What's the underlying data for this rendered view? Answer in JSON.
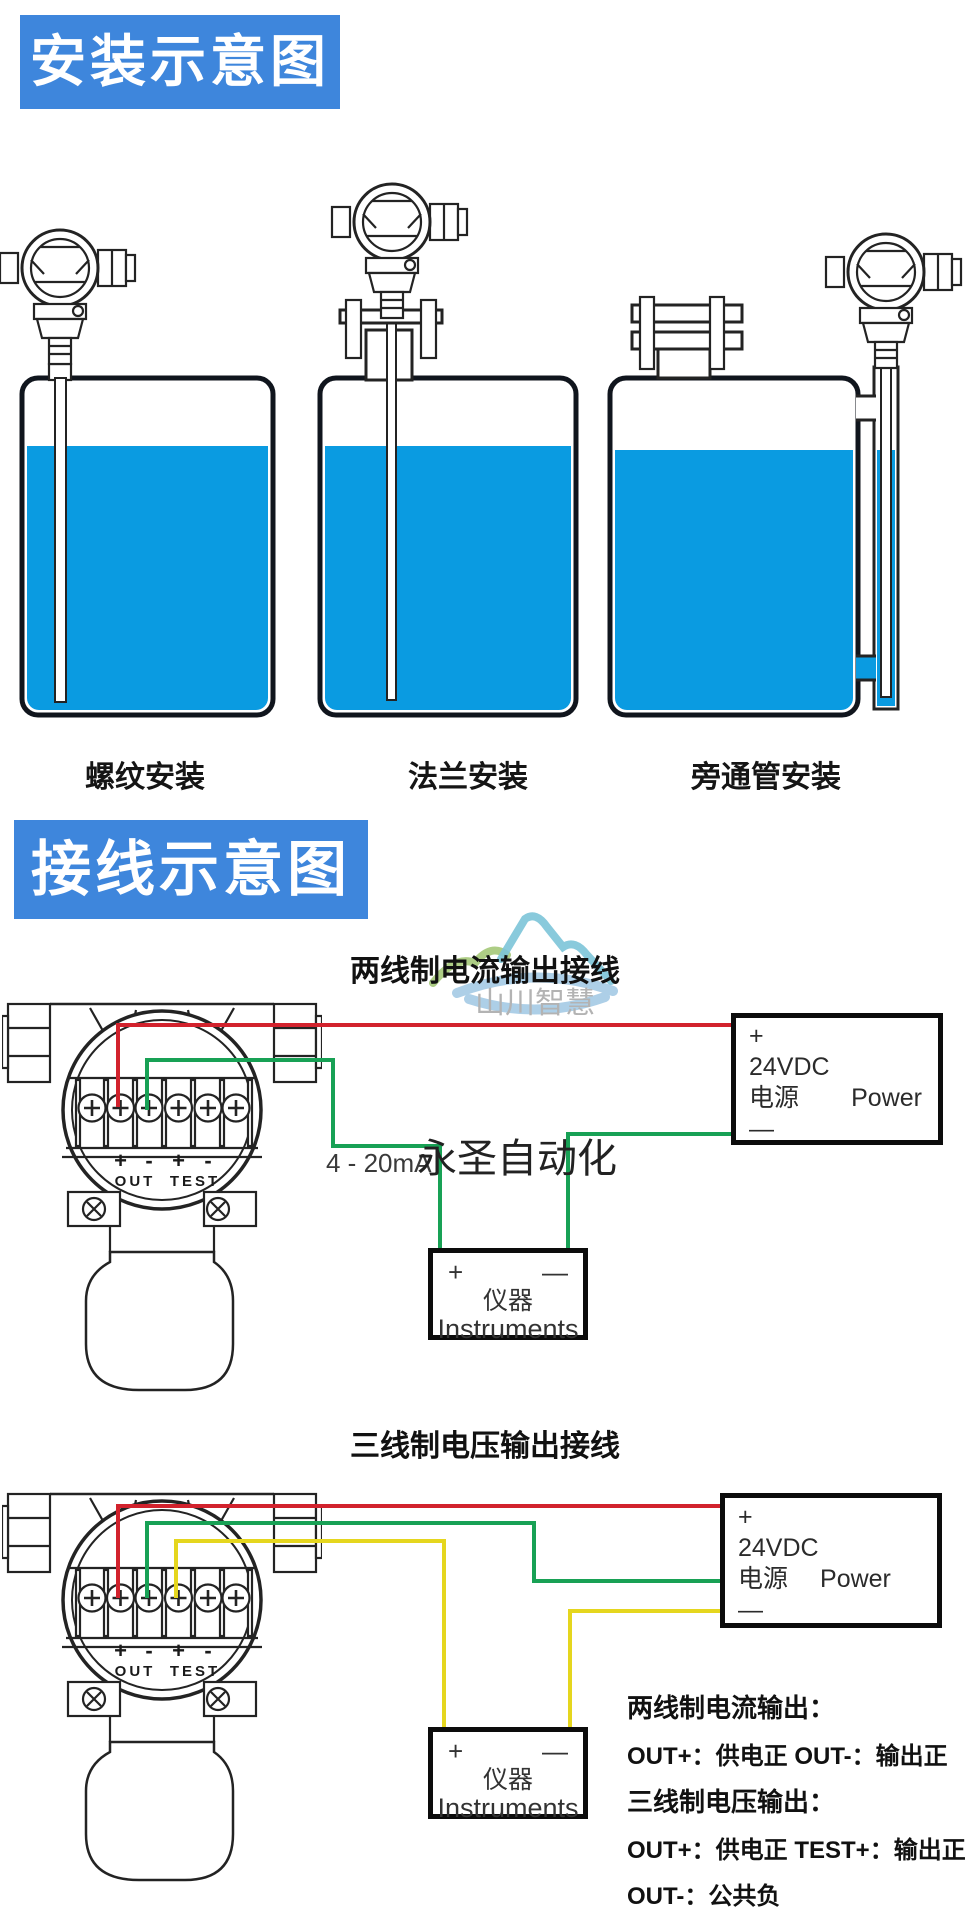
{
  "install": {
    "banner": "安装示意图",
    "mount_labels": [
      "螺纹安装",
      "法兰安装",
      "旁通管安装"
    ]
  },
  "wiring": {
    "banner": "接线示意图",
    "terminals": {
      "pm": [
        "+",
        "-",
        "+",
        "-"
      ],
      "out": "OUT",
      "test": "TEST"
    },
    "watermark": {
      "brand": "山川智慧",
      "overlay": "永圣自动化"
    },
    "diagram1": {
      "title": "两线制电流输出接线",
      "signal": "4 - 20mA",
      "power": {
        "plus": "+",
        "volt": "24VDC",
        "cn": "电源",
        "en": "Power",
        "minus": "—"
      },
      "instrument": {
        "plus": "+",
        "minus": "—",
        "cn": "仪器",
        "en": "Instruments"
      }
    },
    "diagram2": {
      "title": "三线制电压输出接线",
      "power": {
        "plus": "+",
        "volt": "24VDC",
        "cn": "电源",
        "en": "Power",
        "minus": "—"
      },
      "instrument": {
        "plus": "+",
        "minus": "—",
        "cn": "仪器",
        "en": "Instruments"
      }
    },
    "notes": [
      "两线制电流输出：",
      "OUT+：供电正  OUT-：输出正",
      "三线制电压输出：",
      "OUT+：供电正 TEST+：输出正",
      "OUT-：公共负"
    ]
  },
  "colors": {
    "banner_blue": "#3e86dc",
    "water_blue": "#0a9be1",
    "wire_red": "#d2222d",
    "wire_green": "#18a155",
    "wire_yellow": "#e5d61e"
  }
}
